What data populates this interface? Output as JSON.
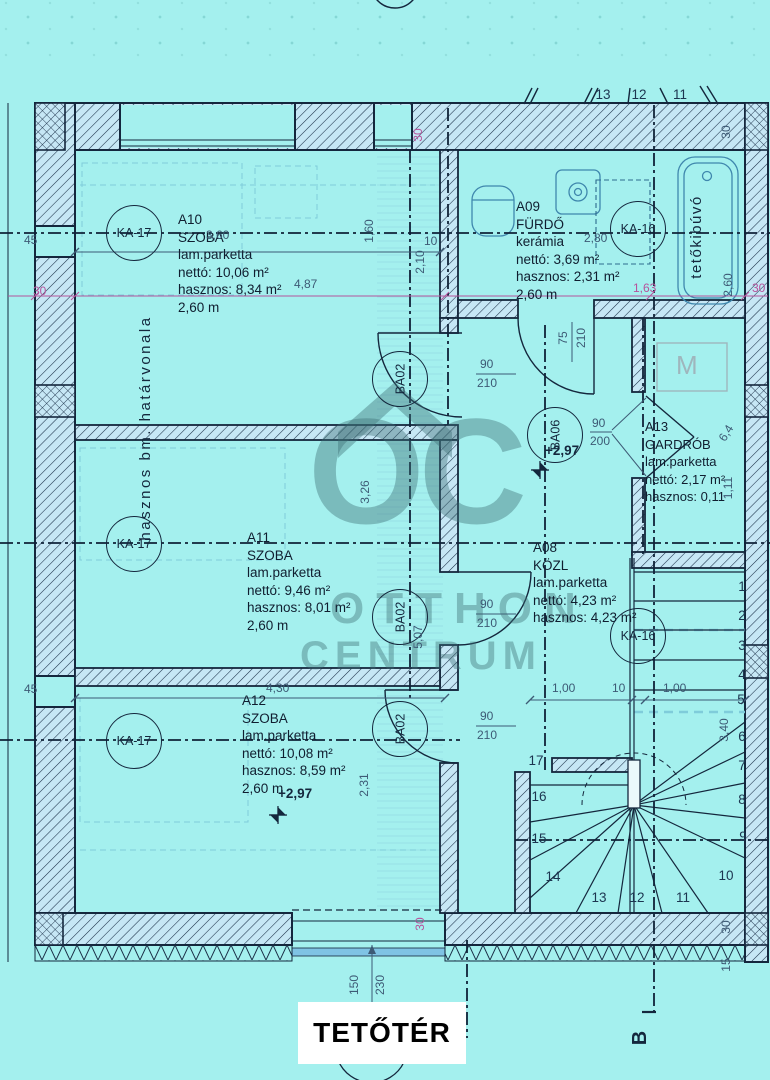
{
  "title": "TETŐTÉR",
  "watermark": {
    "oc": "OC",
    "otthon": "OTTHON",
    "centrum": "CENTRUM"
  },
  "rooms": {
    "a10": {
      "id": "A10",
      "name": "SZOBA",
      "floor": "lam.parketta",
      "netto": "nettó: 10,06 m²",
      "useful": "hasznos: 8,34 m²",
      "height": "2,60 m"
    },
    "a09": {
      "id": "A09",
      "name": "FÜRDŐ",
      "floor": "kerámia",
      "netto": "nettó: 3,69 m²",
      "useful": "hasznos: 2,31 m²",
      "height": "2,60 m"
    },
    "a11": {
      "id": "A11",
      "name": "SZOBA",
      "floor": "lam.parketta",
      "netto": "nettó: 9,46 m²",
      "useful": "hasznos: 8,01 m²",
      "height": "2,60 m"
    },
    "a08": {
      "id": "A08",
      "name": "KÖZL",
      "floor": "lam.parketta",
      "netto": "nettó: 4,23 m²",
      "useful": "hasznos: 4,23 m²"
    },
    "a12": {
      "id": "A12",
      "name": "SZOBA",
      "floor": "lam.parketta",
      "netto": "nettó: 10,08 m²",
      "useful": "hasznos: 8,59 m²",
      "height": "2,60 m"
    },
    "a13": {
      "id": "A13",
      "name": "GARDRÓB",
      "floor": "lam.parketta",
      "netto": "nettó: 2,17 m²",
      "useful": "hasznos: 0,11"
    }
  },
  "markers": {
    "ka17": "KA-17",
    "ka16": "KA-16",
    "ba02": "BA02",
    "ba06": "BA06",
    "mirror": "M",
    "section": "B"
  },
  "annotations": {
    "boundary": "hasznos bm. határvonala",
    "roof_hatch": "tetőkibúvó",
    "elevation": "+2,97"
  },
  "dims": {
    "w360": "3,60",
    "w487": "4,87",
    "w160": "1,60",
    "w210": "2,10",
    "t10": "10",
    "w280": "2,80",
    "w163": "1,63",
    "w260": "2,60",
    "t30": "30",
    "t45": "45",
    "w326": "3,26",
    "w507": "5,07",
    "d75": "75",
    "d210": "210",
    "d90": "90",
    "d200": "200",
    "w100": "1,00",
    "w430": "4,30",
    "w231": "2,31",
    "w340": "3,40",
    "w111": "1,11",
    "w64": "6,4",
    "w150": "150",
    "w230": "230",
    "t15": "15"
  },
  "stairs": {
    "numbers": [
      "1",
      "2",
      "3",
      "4",
      "5",
      "6",
      "7",
      "8",
      "9",
      "10",
      "11",
      "12",
      "13",
      "14",
      "15",
      "16",
      "17"
    ]
  }
}
